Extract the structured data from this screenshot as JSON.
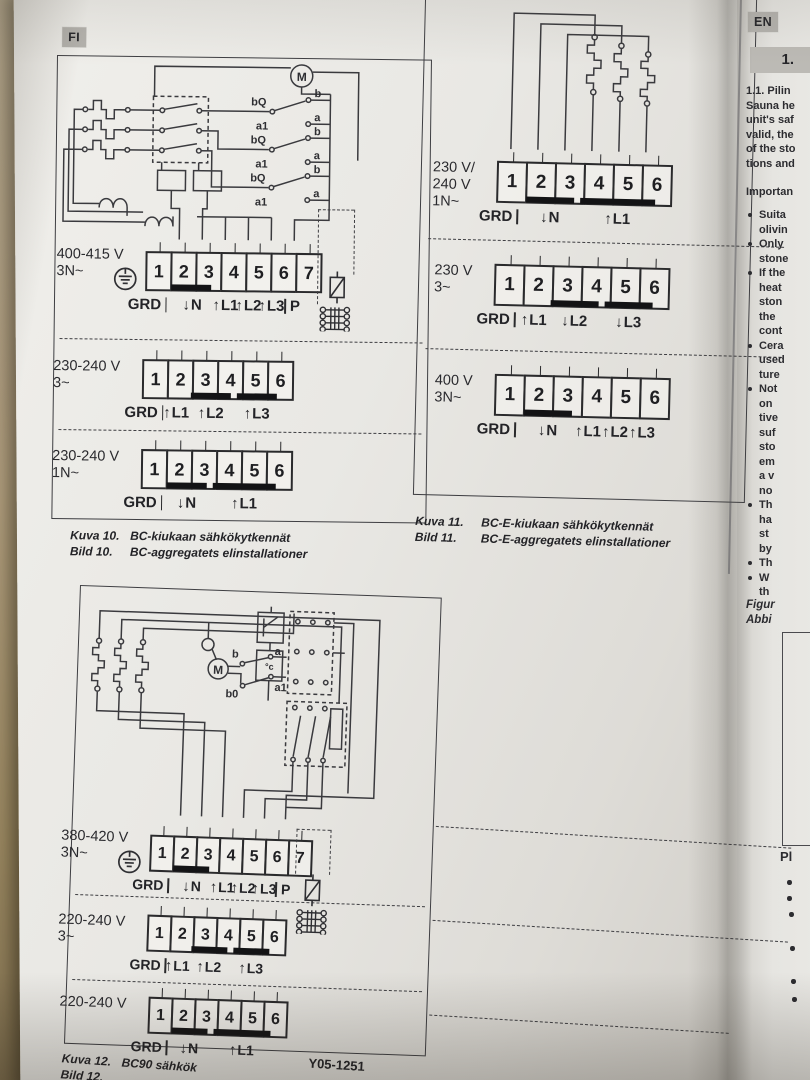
{
  "page": {
    "lang_badge_left": "FI",
    "lang_badge_right": "EN",
    "part_number": "Y05-1251",
    "icons": {
      "arrow_up": "↑",
      "arrow_down": "↓"
    }
  },
  "bc": {
    "schematic": {
      "motor": "M",
      "contacts": [
        [
          "bQ",
          "a1",
          "b",
          "a"
        ],
        [
          "bQ",
          "a1",
          "b",
          "a"
        ],
        [
          "bQ",
          "a1",
          "b",
          "a"
        ]
      ]
    },
    "rows": [
      {
        "voltage": [
          "400-415 V",
          "3N~"
        ],
        "ground": true,
        "cells": [
          "1",
          "2",
          "3",
          "4",
          "5",
          "6",
          "7"
        ],
        "bridges": [
          [
            2,
            3
          ]
        ],
        "labels": [
          {
            "text": "GRD",
            "at": 0.6,
            "tick": "r"
          },
          {
            "text": "N",
            "at": 2.55,
            "arrow": "down"
          },
          {
            "text": "L1",
            "at": 4,
            "arrow": "up"
          },
          {
            "text": "L2",
            "at": 5,
            "arrow": "up"
          },
          {
            "text": "L3",
            "at": 6,
            "arrow": "up"
          },
          {
            "text": "P",
            "at": 6.9,
            "tick": "l"
          }
        ]
      },
      {
        "voltage": [
          "230-240 V",
          "3~"
        ],
        "cells": [
          "1",
          "2",
          "3",
          "4",
          "5",
          "6"
        ],
        "bridges": [
          [
            3,
            4
          ],
          [
            5,
            6
          ]
        ],
        "labels": [
          {
            "text": "GRD",
            "at": 0.6,
            "tick": "r"
          },
          {
            "text": "L1",
            "at": 2,
            "arrow": "up"
          },
          {
            "text": "L2",
            "at": 3.5,
            "arrow": "up"
          },
          {
            "text": "L3",
            "at": 5.5,
            "arrow": "up"
          }
        ]
      },
      {
        "voltage": [
          "230-240 V",
          "1N~"
        ],
        "cells": [
          "1",
          "2",
          "3",
          "4",
          "5",
          "6"
        ],
        "bridges": [
          [
            2,
            3
          ],
          [
            4,
            6
          ]
        ],
        "labels": [
          {
            "text": "GRD",
            "at": 0.6,
            "tick": "r"
          },
          {
            "text": "N",
            "at": 2.5,
            "arrow": "down"
          },
          {
            "text": "L1",
            "at": 5,
            "arrow": "up"
          }
        ]
      }
    ],
    "caption": {
      "rows": [
        [
          "Kuva 10.",
          "BC-kiukaan sähkökytkennät"
        ],
        [
          "Bild 10.",
          "BC-aggregatets elinstallationer"
        ]
      ]
    }
  },
  "bce": {
    "rows": [
      {
        "voltage": [
          "230 V/",
          "240 V",
          "1N~"
        ],
        "cells": [
          "1",
          "2",
          "3",
          "4",
          "5",
          "6"
        ],
        "bridges": [
          [
            2,
            3
          ],
          [
            4,
            6
          ]
        ],
        "labels": [
          {
            "text": "GRD",
            "at": 0.6,
            "tick": "r"
          },
          {
            "text": "N",
            "at": 2.5,
            "arrow": "down"
          },
          {
            "text": "L1",
            "at": 5,
            "arrow": "up"
          }
        ]
      },
      {
        "voltage": [
          "230 V",
          "3~"
        ],
        "cells": [
          "1",
          "2",
          "3",
          "4",
          "5",
          "6"
        ],
        "bridges": [
          [
            3,
            4
          ],
          [
            5,
            6
          ]
        ],
        "labels": [
          {
            "text": "GRD",
            "at": 0.6,
            "tick": "r"
          },
          {
            "text": "L1",
            "at": 2,
            "arrow": "up"
          },
          {
            "text": "L2",
            "at": 3.5,
            "arrow": "down"
          },
          {
            "text": "L3",
            "at": 5.5,
            "arrow": "down"
          }
        ]
      },
      {
        "voltage": [
          "400 V",
          "3N~"
        ],
        "cells": [
          "1",
          "2",
          "3",
          "4",
          "5",
          "6"
        ],
        "bridges": [
          [
            2,
            3
          ]
        ],
        "labels": [
          {
            "text": "GRD",
            "at": 0.6,
            "tick": "r"
          },
          {
            "text": "N",
            "at": 2.5,
            "arrow": "down"
          },
          {
            "text": "L1",
            "at": 4,
            "arrow": "up"
          },
          {
            "text": "L2",
            "at": 5,
            "arrow": "up"
          },
          {
            "text": "L3",
            "at": 6,
            "arrow": "up"
          }
        ]
      }
    ],
    "caption": {
      "rows": [
        [
          "Kuva 11.",
          "BC-E-kiukaan sähkökytkennät"
        ],
        [
          "Bild 11.",
          "BC-E-aggregatets elinstallationer"
        ]
      ]
    }
  },
  "bc90": {
    "schematic": {
      "motor": "M",
      "b": "b",
      "a": "a",
      "b0": "b0",
      "a1": "a1",
      "thermo": "°c"
    },
    "rows": [
      {
        "voltage": [
          "380-420 V",
          "3N~"
        ],
        "ground": true,
        "cells": [
          "1",
          "2",
          "3",
          "4",
          "5",
          "6",
          "7"
        ],
        "bridges": [
          [
            2,
            3
          ]
        ],
        "labels": [
          {
            "text": "GRD",
            "at": 0.6,
            "tick": "r"
          },
          {
            "text": "N",
            "at": 2.55,
            "arrow": "down"
          },
          {
            "text": "L1",
            "at": 4,
            "arrow": "up"
          },
          {
            "text": "L2",
            "at": 5,
            "arrow": "up"
          },
          {
            "text": "L3",
            "at": 6,
            "arrow": "up"
          },
          {
            "text": "P",
            "at": 6.9,
            "tick": "l"
          }
        ]
      },
      {
        "voltage": [
          "220-240 V",
          "3~"
        ],
        "cells": [
          "1",
          "2",
          "3",
          "4",
          "5",
          "6"
        ],
        "bridges": [
          [
            3,
            4
          ],
          [
            5,
            6
          ]
        ],
        "labels": [
          {
            "text": "GRD",
            "at": 0.6,
            "tick": "r"
          },
          {
            "text": "L1",
            "at": 2,
            "arrow": "up"
          },
          {
            "text": "L2",
            "at": 3.5,
            "arrow": "up"
          },
          {
            "text": "L3",
            "at": 5.5,
            "arrow": "up"
          }
        ]
      },
      {
        "voltage": [
          "220-240 V"
        ],
        "cells": [
          "1",
          "2",
          "3",
          "4",
          "5",
          "6"
        ],
        "bridges": [
          [
            2,
            3
          ],
          [
            4,
            6
          ]
        ],
        "labels": [
          {
            "text": "GRD",
            "at": 0.6,
            "tick": "r"
          },
          {
            "text": "N",
            "at": 2.5,
            "arrow": "down"
          },
          {
            "text": "L1",
            "at": 5,
            "arrow": "up"
          }
        ]
      }
    ],
    "caption": {
      "rows": [
        [
          "Kuva 12.",
          "BC90 sähkök"
        ],
        [
          "Bild 12.",
          ""
        ]
      ]
    }
  },
  "right_column": {
    "section_number": "1.",
    "intro_lines": [
      "1.1. Pilin",
      "Sauna he",
      "unit's saf",
      "valid, the",
      "of the sto",
      "tions and"
    ],
    "important_label": "Importan",
    "bullets": [
      [
        "Suita",
        "olivin"
      ],
      [
        "Only",
        "stone"
      ],
      [
        "If the",
        "heat",
        "ston",
        "the",
        "cont"
      ],
      [
        "Cera",
        "used",
        "ture"
      ],
      [
        "Not",
        "on",
        "tive",
        "suf",
        "sto",
        "em",
        "a v",
        "no"
      ],
      [
        "Th",
        "ha",
        "st",
        "by"
      ],
      [
        "Th"
      ],
      [
        "W",
        "th"
      ]
    ],
    "figure_caption": [
      "Figur",
      "Abbi"
    ],
    "note_heading": "Pl"
  }
}
